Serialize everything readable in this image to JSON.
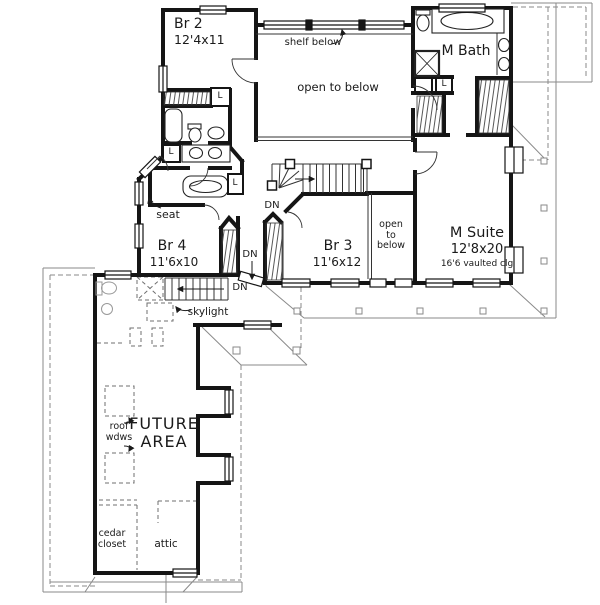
{
  "plan": {
    "rooms": {
      "br2": {
        "name": "Br 2",
        "dims": "12'4x11"
      },
      "br3": {
        "name": "Br 3",
        "dims": "11'6x12"
      },
      "br4": {
        "name": "Br 4",
        "dims": "11'6x10"
      },
      "m_suite": {
        "name": "M Suite",
        "dims": "12'8x20",
        "ceiling": "16'6 vaulted clg"
      },
      "m_bath": {
        "name": "M Bath"
      },
      "future_area": {
        "name": "FUTURE\nAREA"
      },
      "cedar_closet": {
        "name": "cedar\ncloset"
      },
      "attic": {
        "name": "attic"
      }
    },
    "annotations": {
      "shelf_below": "shelf below",
      "open_to_below": "open to below",
      "open_to_below_small": "open\nto\nbelow",
      "seat": "seat",
      "skylight": "skylight",
      "roof_windows": "roof\nwdws",
      "down": "DN",
      "linen": "L"
    },
    "colors": {
      "ink": "#1a1a1a",
      "dashed": "#808080",
      "paper": "#ffffff"
    }
  }
}
